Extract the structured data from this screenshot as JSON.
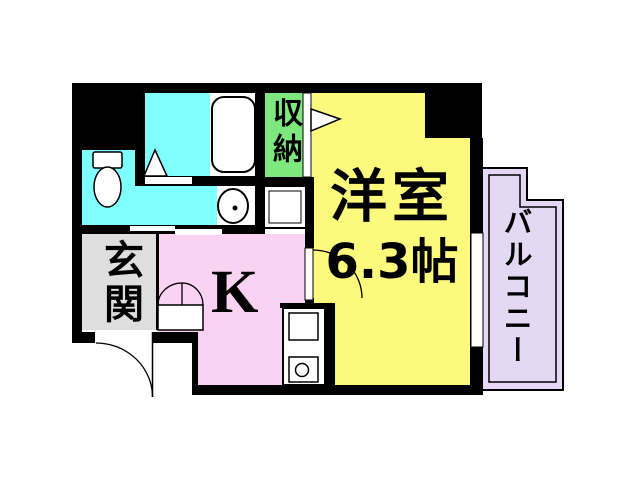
{
  "document": {
    "type": "apartment floor plan"
  },
  "colors": {
    "wall": "#000000",
    "paper": "#FFFFFF",
    "line": "#000000"
  },
  "rooms": {
    "western_room": {
      "label": "洋室",
      "size": "6.3帖",
      "color": "#FDF97D"
    },
    "kitchen": {
      "label": "K",
      "color": "#FAD2F2"
    },
    "entrance": {
      "label": "玄関",
      "color": "#DEDEDE"
    },
    "storage": {
      "label": "収納",
      "color": "#7EE87E"
    },
    "balcony": {
      "label": "バルコニー",
      "color": "#E4D8F4"
    },
    "bathroom": {
      "color": "#80FFFF"
    }
  },
  "fixtures": [
    "bathtub",
    "shower-unit",
    "toilet",
    "wash-basin",
    "washing-machine-space",
    "storage-closet-door",
    "room-door",
    "bifold-door",
    "entrance-door",
    "sliding-door",
    "balcony-window",
    "kitchen-stove"
  ]
}
